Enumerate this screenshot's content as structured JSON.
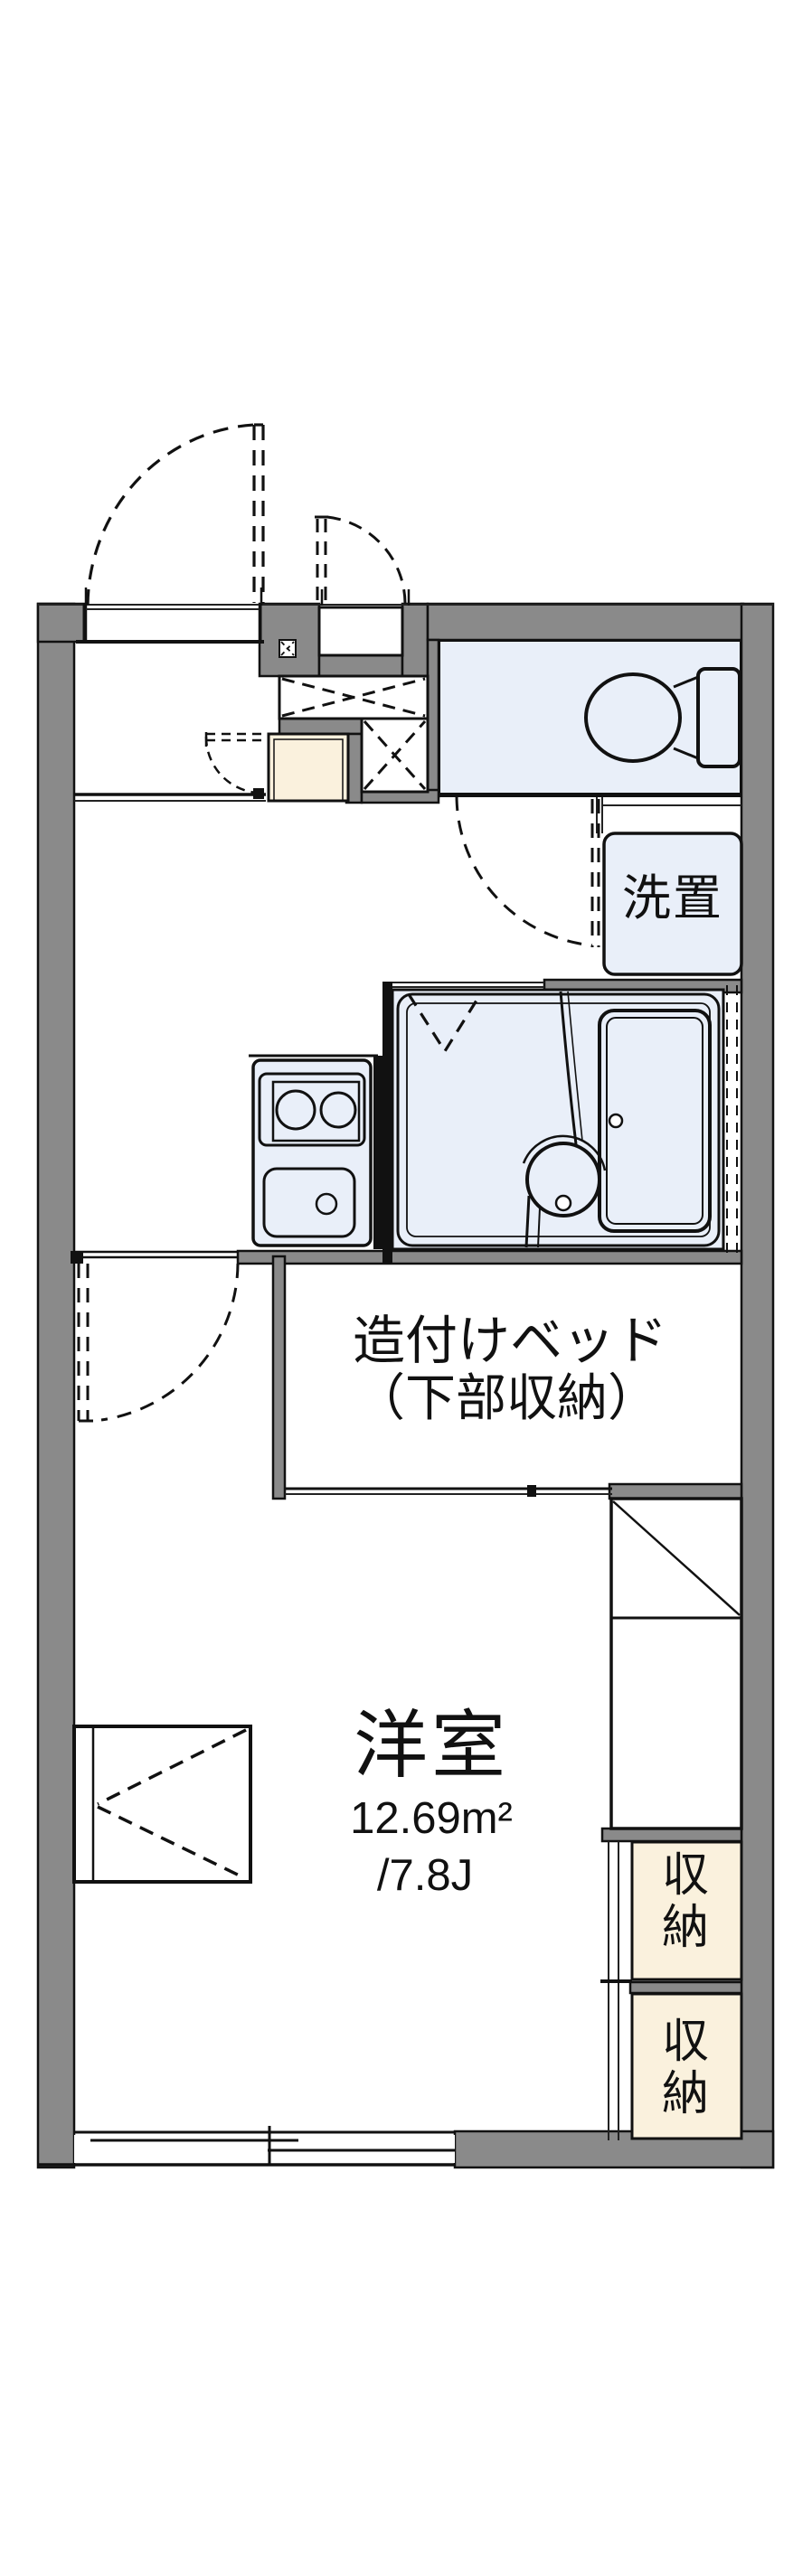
{
  "floorplan": {
    "colors": {
      "wall_gray": "#8A8A8A",
      "outline_black": "#111111",
      "wet_area_blue": "#E9EFF9",
      "storage_cream": "#FAF1DD",
      "background": "#FFFFFF"
    },
    "labels": {
      "laundry": "洗置",
      "bed_line1": "造付けベッド",
      "bed_line2": "（下部収納）",
      "room_name": "洋室",
      "room_area_sqm": "12.69m²",
      "room_area_tatami": "/7.8J",
      "storage_upper": "収納",
      "storage_lower": "収納"
    }
  }
}
